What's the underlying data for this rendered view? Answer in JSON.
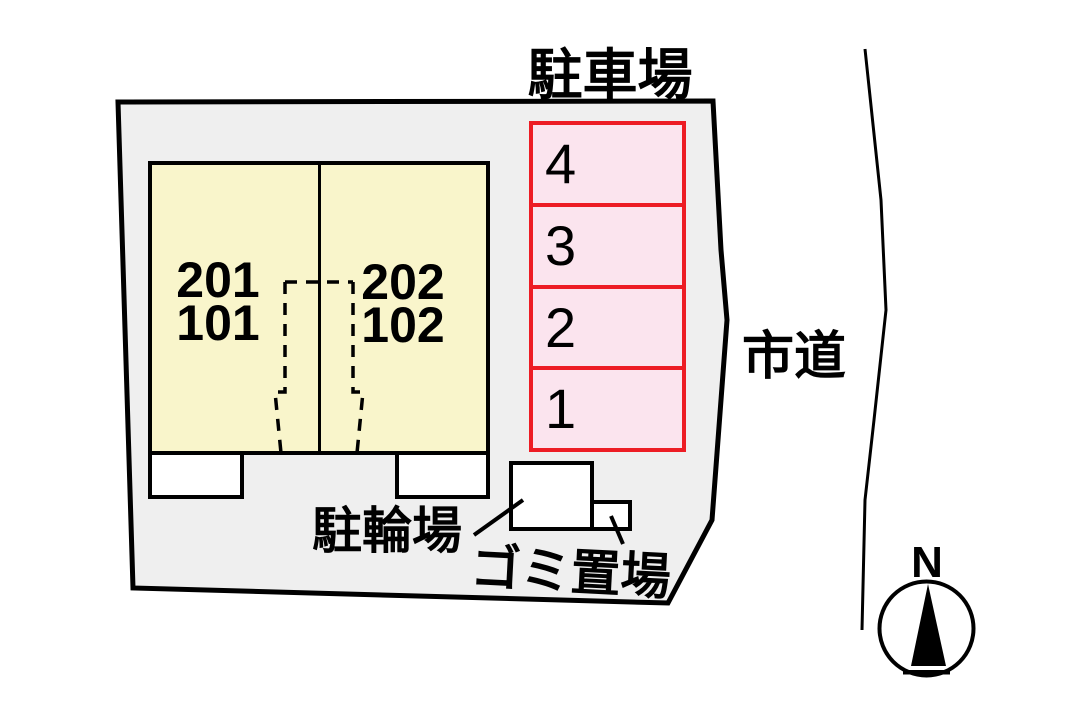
{
  "site": {
    "parking": {
      "title": "駐車場",
      "spaces": [
        "4",
        "3",
        "2",
        "1"
      ]
    },
    "building": {
      "units_left": {
        "upper": "201",
        "lower": "101"
      },
      "units_right": {
        "upper": "202",
        "lower": "102"
      }
    },
    "bicycle_parking_label": "駐輪場",
    "garbage_area_label": "ゴミ置場",
    "road_label": "市道",
    "compass_north": "N"
  },
  "colors": {
    "site_fill": "#efefef",
    "building_fill": "#f9f5cb",
    "parking_fill": "#fbe4ee",
    "parking_border": "#ed1c24",
    "line_color": "#000000"
  }
}
